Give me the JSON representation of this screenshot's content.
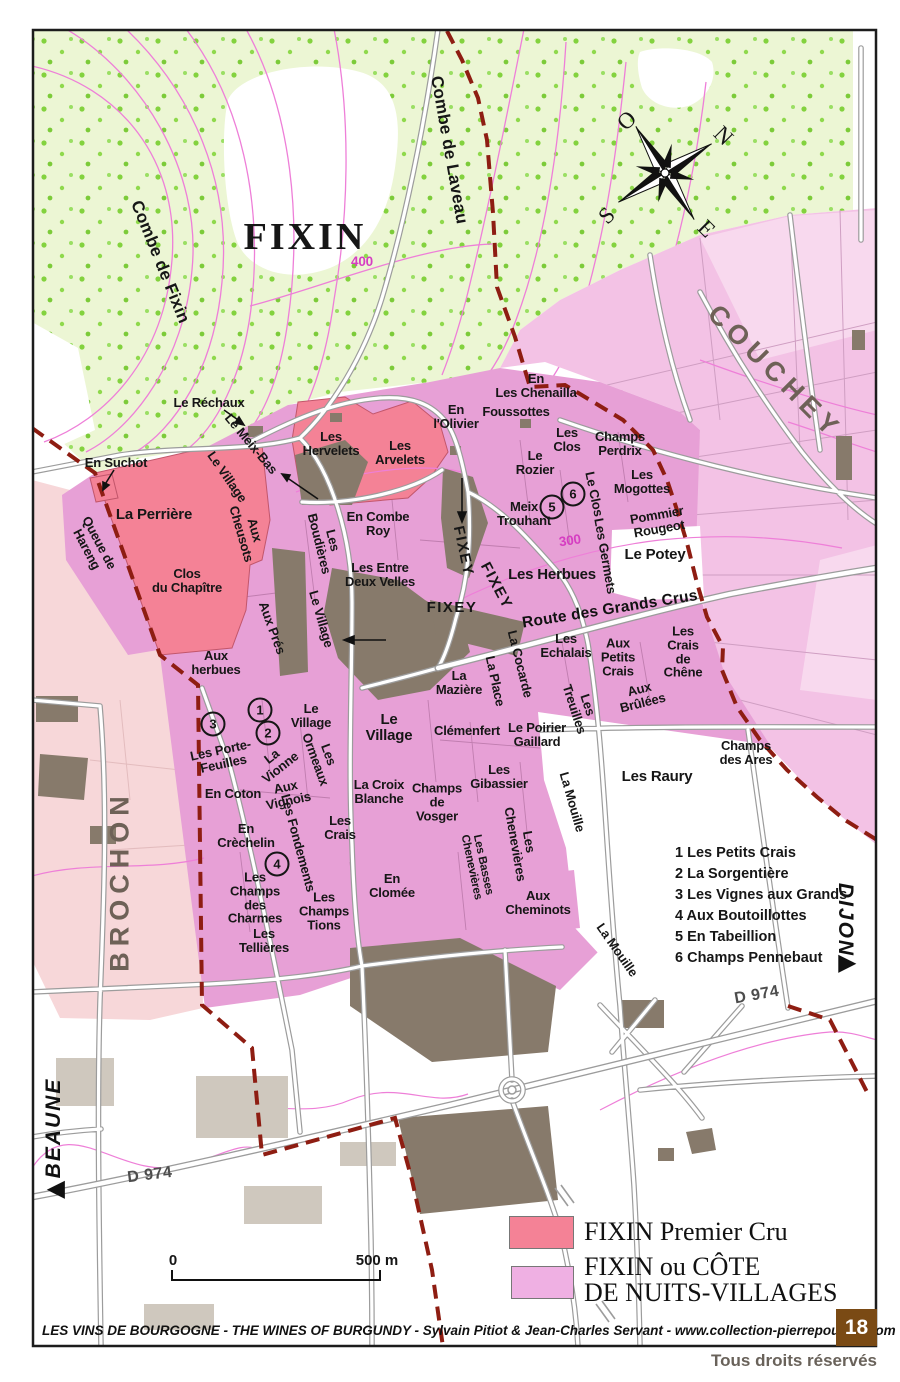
{
  "map": {
    "places": {
      "fixin": "FIXIN",
      "couchey": "COUCHEY",
      "brochon": "BROCHON",
      "beaune": "BEAUNE",
      "dijon": "DIJON",
      "fixey_a": "FIXEY",
      "fixey_b": "FIXEY",
      "fixey_c": "FIXEY",
      "beaune_arrow": "◀",
      "dijon_arrow": "▶"
    },
    "terrain": {
      "combe_fixin": "Combe de Fixin",
      "combe_laveau": "Combe de Laveau",
      "contour_400": "400",
      "contour_300": "300"
    },
    "roads": {
      "d974_a": "D 974",
      "d974_b": "D 974",
      "route_grands_crus": "Route des Grands Crus"
    },
    "compass": {
      "o": "O",
      "n": "N",
      "s": "S",
      "e": "E"
    },
    "vineyards": {
      "le_rechaux": "Le Réchaux",
      "en_suchot": "En Suchot",
      "le_meix_bas": "Le Meix-Bas",
      "village_road_a": "Le Village",
      "les_hervelets": "Les\nHervelets",
      "les_arvelets": "Les\nArvelets",
      "en_lolivier": "En\nl'Olivier",
      "en_chenailla": "En\nLes Chenailla",
      "foussottes": "Foussottes",
      "les_clos": "Les\nClos",
      "champs_perdrix": "Champs\nPerdrix",
      "le_rozier": "Le\nRozier",
      "les_mogottes": "Les\nMogottes",
      "meix_trouhant": "Meix\nTrouhant",
      "le_clos_rot": "Le Clos",
      "pommier_rougeot": "Pommier\nRougeot",
      "le_potey": "Le Potey",
      "les_germets": "Les Germets",
      "la_perriere": "La Perrière",
      "queue_hareng": "Queue de\nHareng",
      "aux_cheusots": "Aux\nCheusots",
      "les_boudieres": "Les\nBoudières",
      "en_combe_roy": "En Combe\nRoy",
      "entre_deux_velles": "Les Entre\nDeux Velles",
      "clos_chapitre": "Clos\ndu Chapître",
      "village_road_b": "Le Village",
      "aux_pres": "Aux Prés",
      "les_herbues": "Les Herbues",
      "aux_herbues": "Aux\nherbues",
      "la_cocarde": "La Cocarde",
      "la_place": "La Place",
      "les_echalais": "Les\nEchalais",
      "aux_petits_crais": "Aux\nPetits\nCrais",
      "crais_de_chene": "Les\nCrais\nde\nChêne",
      "les_treuilles": "Les\nTreuilles",
      "aux_brulees": "Aux\nBrûlées",
      "la_maziere": "La\nMazière",
      "clemenfert": "Clémenfert",
      "poirier_gaillard": "Le Poirier\nGaillard",
      "champs_ares": "Champs\ndes Ares",
      "village_small": "Le\nVillage",
      "les_ormeaux": "Les\nOrmeaux",
      "porte_feuilles": "Les Porte-\nFeuilles",
      "la_vionne": "La\nVionne",
      "village_big": "Le\nVillage",
      "en_coton": "En Coton",
      "aux_vignois": "Aux\nVignois",
      "croix_blanche": "La Croix\nBlanche",
      "champs_vosger": "Champs\nde\nVosger",
      "les_gibassier": "Les\nGibassier",
      "les_raury": "Les Raury",
      "la_mouille_a": "La Mouille",
      "la_mouille_b": "La Mouille",
      "en_crechelin": "En\nCrèchelin",
      "les_fondements": "Les Fondements",
      "les_crais": "Les\nCrais",
      "champs_charmes": "Les\nChamps\ndes\nCharmes",
      "champs_tions": "Les\nChamps\nTions",
      "en_clomee": "En\nClomée",
      "chenevieres": "Les\nChenevières",
      "basses_chenevieres": "Les Basses\nChenevières",
      "aux_cheminots": "Aux\nCheminots",
      "tellieres": "Les\nTellières"
    },
    "numbered_circles": {
      "c1": "1",
      "c2": "2",
      "c3": "3",
      "c4": "4",
      "c5": "5",
      "c6": "6"
    },
    "key_list": [
      "1 Les Petits Crais",
      "2 La Sorgentière",
      "3 Les Vignes aux Grands",
      "4 Aux Boutoillottes",
      "5 En Tabeillion",
      "6 Champs Pennebaut"
    ],
    "scale": {
      "zero": "0",
      "label": "500 m"
    }
  },
  "legend": {
    "items": [
      {
        "label": "FIXIN Premier Cru",
        "color": "#f48296",
        "swatch_style": "background:#f48296"
      },
      {
        "label": "FIXIN ou CÔTE\nDE NUITS-VILLAGES",
        "color": "#efb0e3",
        "swatch_style": "background:#efb0e3"
      }
    ]
  },
  "footer": {
    "credit": "LES VINS DE BOURGOGNE - THE WINES OF BURGUNDY - Sylvain Pitiot & Jean-Charles Servant - www.collection-pierrepoupon.com",
    "page": "18",
    "rights": "Tous droits réservés"
  },
  "colors": {
    "premier_cru": "#f48296",
    "villages_pink": "#e7a0d6",
    "couchey_pink": "#f3c2e5",
    "brochon_pink": "#f7d7d9",
    "forest_green": "#ecf6d4",
    "forest_dot": "#83d23e",
    "building": "#877a6b",
    "building_light": "#cfc8be",
    "road_casing": "#9c9c9c",
    "boundary_dashed": "#8e1d12",
    "contour_magenta": "#ee7fd8",
    "frame": "#1c1c1c",
    "page_box_brown": "#7a4a14"
  }
}
